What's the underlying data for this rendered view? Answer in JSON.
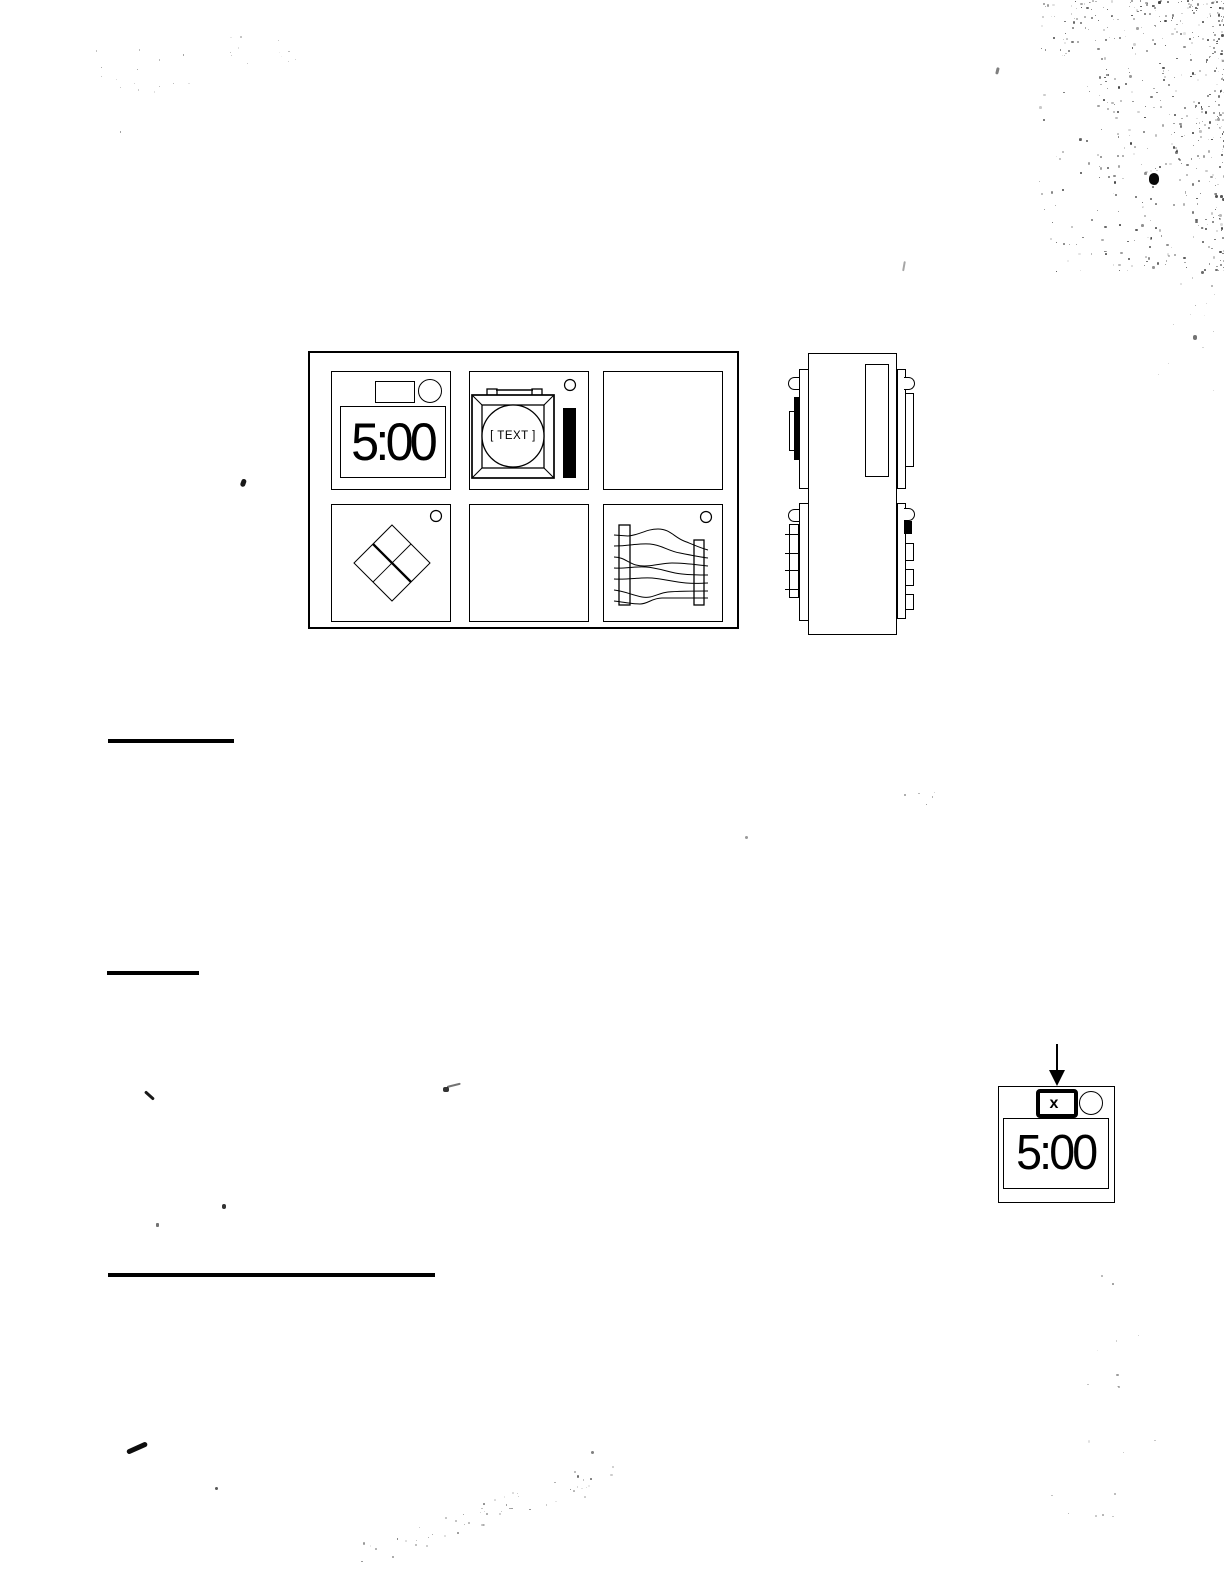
{
  "page": {
    "paper_color": "#ffffff",
    "ink_color": "#000000"
  },
  "watch_grid": {
    "faces": [
      {
        "id": "digital-clock-face",
        "time": "5:00"
      },
      {
        "id": "framed-round-dial-face",
        "label": "[ TEXT ]"
      },
      {
        "id": "blank-face-top-right"
      },
      {
        "id": "diamond-pattern-face"
      },
      {
        "id": "blank-face-bottom-middle"
      },
      {
        "id": "squiggle-traces-face"
      }
    ]
  },
  "side_view": {
    "id": "device-side-profile"
  },
  "callout": {
    "button_label": "x",
    "time": "5:00"
  }
}
